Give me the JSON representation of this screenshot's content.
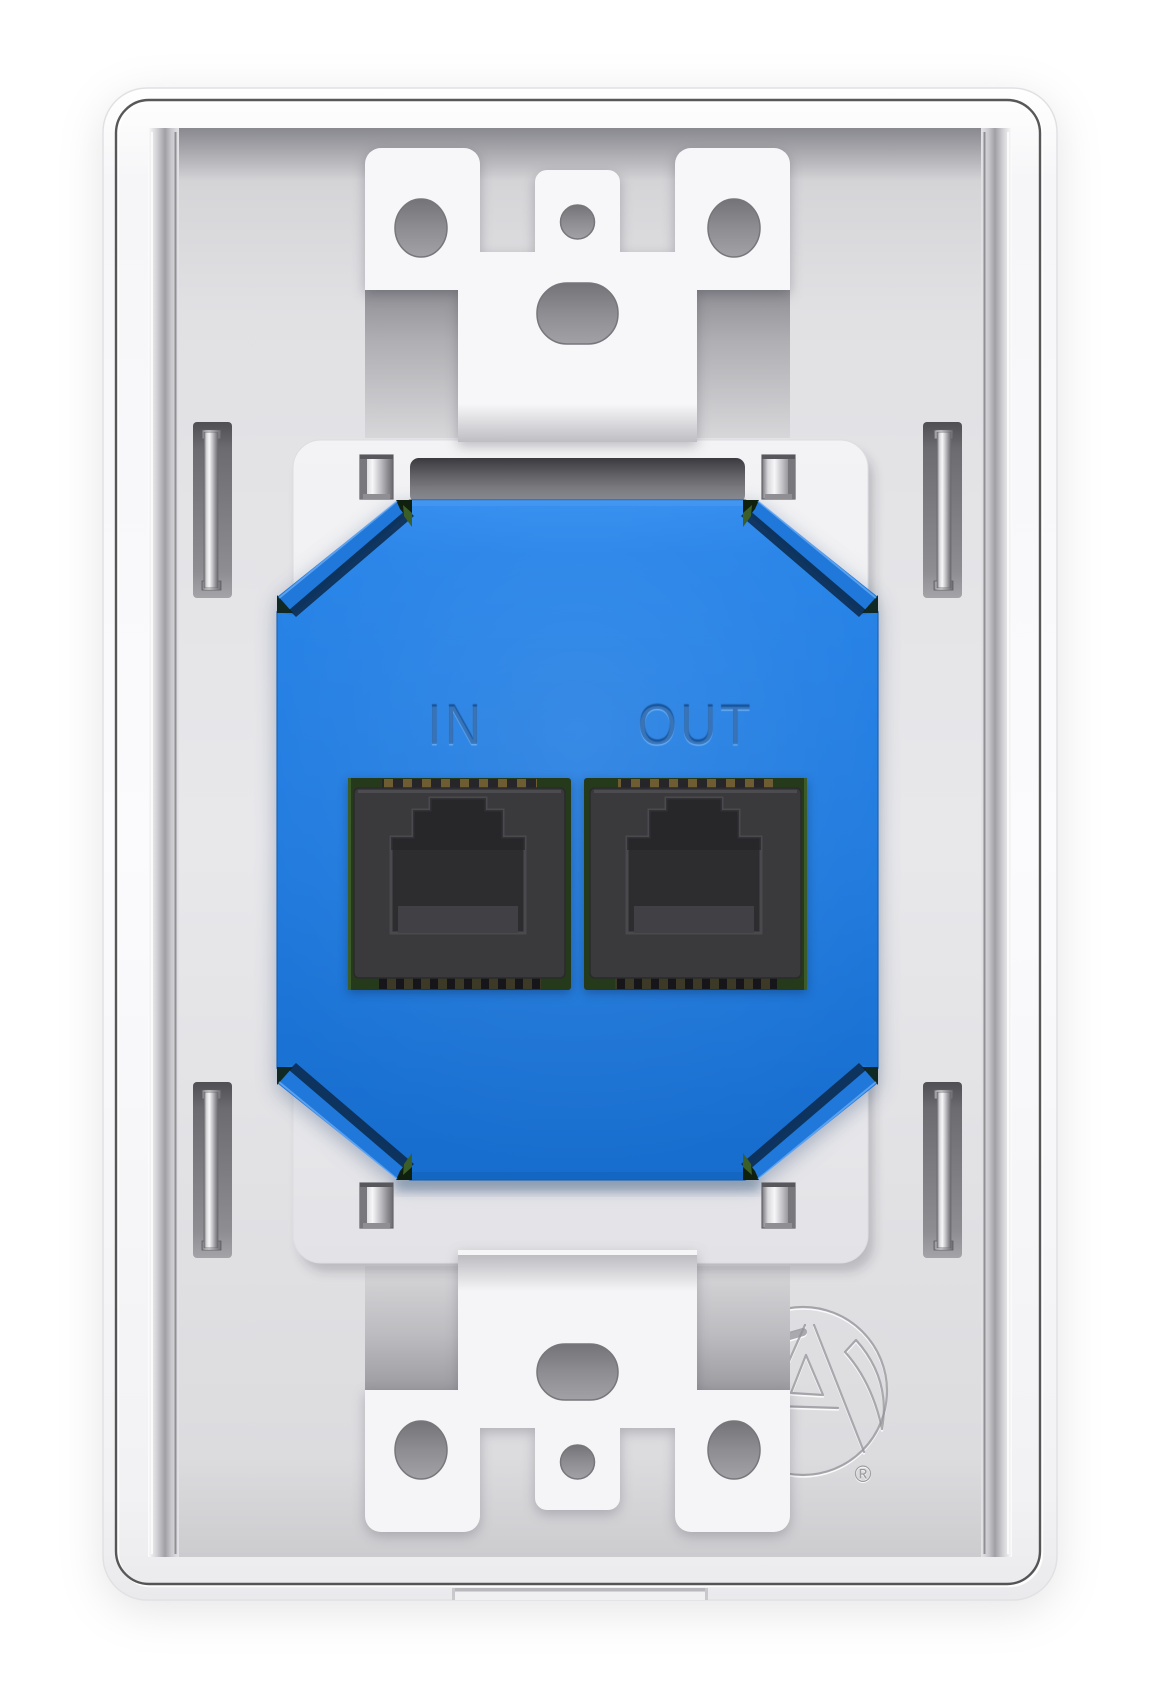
{
  "device": {
    "ports": [
      {
        "id": "in",
        "label": "IN"
      },
      {
        "id": "out",
        "label": "OUT"
      }
    ],
    "logo": {
      "icon": "atlas-logo",
      "registered_mark": "®"
    }
  },
  "colors": {
    "background": "#ffffff",
    "plate_white": "#f8f8fa",
    "recess_gray": "#e6e6e9",
    "mount_plate": "#ededf0",
    "module_blue": "#1e7bdf",
    "jack_dark": "#3a3a3c",
    "pcb_green": "#2e4420",
    "metal_silver": "#c9c9cd",
    "groove_dark": "#2e2e30"
  }
}
